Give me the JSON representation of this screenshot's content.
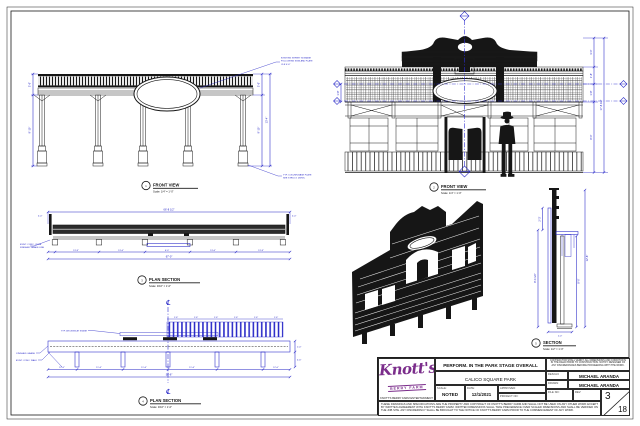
{
  "colors": {
    "line": "#1a1a1a",
    "dimension_blue": "#2424c6",
    "logo_purple": "#7b2d8b"
  },
  "views": {
    "front1": {
      "number": "1",
      "label": "FRONT VIEW",
      "scale": "Scale: 1/4\" = 1'-0\"",
      "dims_left": [
        "3'-6\"",
        "9'-10\""
      ],
      "dims_right": [
        "3'-6\"",
        "9'-10\""
      ],
      "dim_overall_right": "13'-4\"",
      "note_top": [
        "EXISTING STREET SIGNAGE",
        "FOLLOWING SIGN AND PLATE",
        "CLR 4'-6\""
      ],
      "note_bottom": [
        "TYP. COLUMN BASE PLATE",
        "SEE STRUCT. DWGS."
      ]
    },
    "front2": {
      "number": "2",
      "label": "FRONT VIEW",
      "scale": "Scale: 1/4\" = 1'-0\"",
      "dims_right": [
        "3'-0\"",
        "1'-8\"",
        "1'-8\"",
        "8'-0\""
      ],
      "dim_overall_right": "17'-8 1/2\"",
      "dim_left": "1'-8\""
    },
    "plan1": {
      "number": "3",
      "label": "PLAN SECTION",
      "scale": "Scale: 3/16\" = 1'-0\"",
      "dim_overall_top": "66'-8 1/2\"",
      "bays": [
        "13'-9\"",
        "13'-6\"",
        "6'-0\"",
        "13'-6\"",
        "13'-9\""
      ],
      "dim_overall_bottom": "67'-0\"",
      "end_dims": [
        "4'-0\"",
        "4'-0\""
      ],
      "note_left": [
        "EXIST. CONC. CURB",
        "FINISHED GRADE LINE"
      ]
    },
    "plan2": {
      "number": "4",
      "label": "PLAN SECTION",
      "scale": "Scale: 3/16\" = 1'-0\"",
      "centerline_symbol": "℄",
      "deck_dims": [
        "1'-6\"",
        "1'-6\"",
        "1'-6\"",
        "1'-6\"",
        "1'-6\"",
        "1'-6\""
      ],
      "bays": [
        "12'-0\"",
        "11'-6\"",
        "11'-6\"",
        "11'-6\"",
        "12'-0\""
      ],
      "dim_overall_bottom": "58'-6\"",
      "dims_right": [
        "2'-0\"",
        "4'-6\""
      ],
      "note_deck": "TYP. DECKING AT STAGE",
      "note_grade": "FINISHED GRADE",
      "note_walk": "EXIST. CONC. WALK"
    },
    "section": {
      "number": "5",
      "label": "SECTION",
      "scale": "Scale: 1/2\" = 1'-0\"",
      "dim_left": "8'-4 1/2\"",
      "dim_left_top": "2'-3\"",
      "dim_right": "8'-0\"",
      "dim_overall": "12'-8\"",
      "dim_bottom": "2'-0\""
    }
  },
  "titleblock": {
    "logo_name": "Knott's",
    "logo_sub": "BERRY FARM",
    "address_line1": "KNOTT'S BERRY FARM ENTERTAINMENT",
    "address_line2": "8039 BEACH BLVD., BUENA PARK, CA 90620",
    "title": "PERFORM. IN THE PARK STAGE OVERALL",
    "project": "CALICO SQUARE PARK",
    "scale_label": "SCALE:",
    "scale_value": "NOTED",
    "date_label": "DATE:",
    "date_value": "12/1/2021",
    "approved_label": "APPROVED:",
    "job_label": "PROJECT NO:",
    "designed_label": "DESIGN:",
    "designed_value": "MICHAEL ARANDA",
    "drawn_label": "DRAWN:",
    "drawn_value": "MICHAEL ARANDA",
    "file_label": "FILE NO:",
    "rev_label": "REV:",
    "sheet_number": "3",
    "sheet_total": "18",
    "note_box": "CONTRACTOR SHALL VERIFY ALL DIMENSIONS AND CONDITIONS IN THE FIELD PRIOR TO CONSTRUCTION. NOTIFY DESIGNER OF ANY DISCREPANCIES BEFORE PROCEEDING WITH THE WORK.",
    "disclaimer": "THESE DRAWINGS AND SPECIFICATIONS ARE THE PROPERTY AND COPYRIGHT OF KNOTT'S BERRY FARM AND SHALL NOT BE USED ON ANY OTHER WORK EXCEPT BY WRITTEN AGREEMENT WITH KNOTT'S BERRY FARM. WRITTEN DIMENSIONS SHALL TAKE PRECEDENCE OVER SCALED DIMENSIONS AND SHALL BE VERIFIED ON THE JOB SITE. ANY DISCREPANCY SHALL BE BROUGHT TO THE NOTICE OF KNOTT'S BERRY FARM PRIOR TO THE COMMENCEMENT OF ANY WORK."
  }
}
